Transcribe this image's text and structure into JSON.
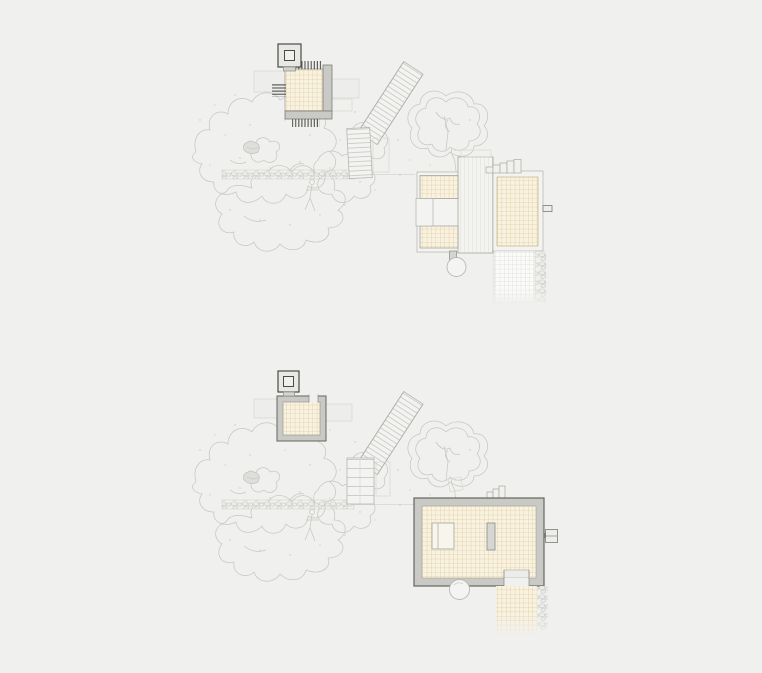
{
  "canvas": {
    "width": 762,
    "height": 673,
    "background": "#f0f0ee"
  },
  "colors": {
    "paper": "#f0f0ee",
    "ink": "#53534e",
    "wall_fill": "#c9c9c5",
    "wall_stroke": "#66665f",
    "outline": "#9a9a94",
    "faint": "#d6d6d2",
    "tree_line": "#c7c7c2",
    "tile_bg": "#f8f2e0",
    "tile_line": "#cfa768",
    "grid_bg": "#fbfbf9",
    "grid_line": "#c9c9c5",
    "deck_bg": "#f3f3f0",
    "deck_line": "#cdcdc9",
    "rung_line": "#bfbfba",
    "stone_fill": "#ecece8",
    "stone_line": "#c8c8c4"
  },
  "scene": {
    "drawing_type": "architectural site plans, two stacked variants (roof plan above, floor plan below), no text labels visible",
    "plans": [
      {
        "name": "upper-plan",
        "elements": [
          "chimney-rooflight",
          "pavilion-roof-grid",
          "louver-combs",
          "side-wings",
          "bent-stair",
          "tree-canopy",
          "heart-tree",
          "stone-path",
          "main-roof-tile-left",
          "roof-deck",
          "main-roof-tile-right",
          "entry-steps",
          "roof-spout",
          "tree-circle",
          "gray-grid-terrace",
          "stone-edge"
        ]
      },
      {
        "name": "lower-plan",
        "elements": [
          "chimney-rooflight",
          "pavilion-room-walls",
          "pavilion-tile-floor",
          "door-opening",
          "bent-stair",
          "tree-canopy",
          "heart-tree",
          "stone-path",
          "main-room-walls",
          "tile-floor",
          "bed-block",
          "partition-wall",
          "door-opening-south",
          "wall-fixture",
          "entry-steps",
          "tilted-stone",
          "tree-circle",
          "tile-terrace",
          "stone-edge"
        ]
      }
    ]
  }
}
